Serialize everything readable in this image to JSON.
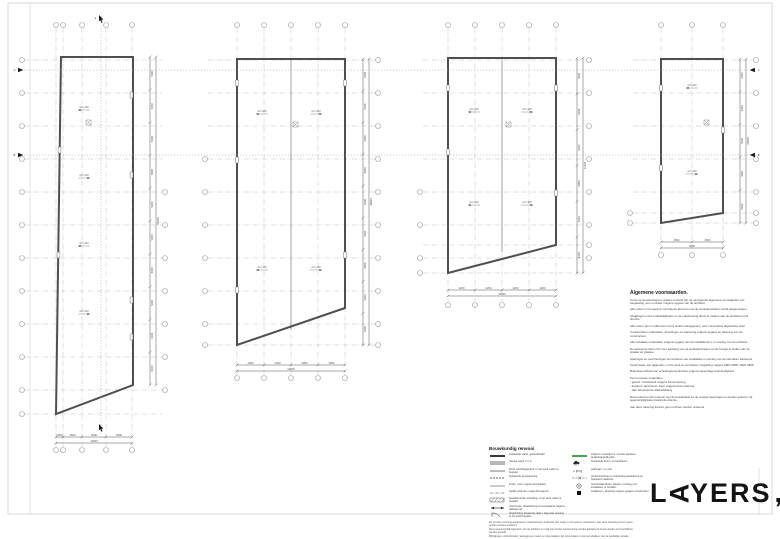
{
  "colors": {
    "grid": "#b9b9b9",
    "wall": "#4f4f4f",
    "dim": "#555555",
    "bubble": "#9a9a9a",
    "section": "#1c1c1c",
    "green": "#2e9e44",
    "frame": "#d9d9d9"
  },
  "logo": {
    "pre": "L",
    "rotated_letter": "A",
    "post": "YERS",
    "comma": ","
  },
  "legend": {
    "title": "Bouwkundig renvooi",
    "left_items": [
      {
        "sym": "line-thick",
        "label": "bestaande wand, gehandhaafd"
      },
      {
        "sym": "line-double",
        "label": "nieuwe wand / n.t.b."
      },
      {
        "sym": "line-double-thin",
        "label": "lichte scheidingswand, in het werk nader te bepalen"
      },
      {
        "sym": "line-dashed",
        "label": "bestaande gevelopening"
      },
      {
        "sym": "line-thin",
        "label": "kozijn, merk volgens kozijnstaat"
      },
      {
        "sym": "line-dashdot",
        "label": "hartlijn stramien / eigendomsgrens"
      },
      {
        "sym": "rect-hatch",
        "label": "brandwerende scheiding, in het werk nader te bepalen"
      },
      {
        "sym": "arrow",
        "label": "vluchtroute, draairichting en loopafstand volgens plattegrond"
      },
      {
        "sym": "arc",
        "label": "draairichting draaiende delen, dagmaat opening in het werk bepalen"
      }
    ],
    "right_items": [
      {
        "sym": "line-green",
        "label": "erfgrens / kavelgrens, nieuwe aanplant landschappelijk plan"
      },
      {
        "sym": "tree",
        "label": "bestaande boom, te handhaven"
      },
      {
        "sym": "text-peil",
        "label": "peilmaat t.o.v. peil"
      },
      {
        "sym": "line-x",
        "label": "terreininrichting en verharding aansluitend op bestaand maaiveld"
      },
      {
        "sym": "circle-dot",
        "label": "hemelwaterafvoer, plaats in overleg met installateur te bepalen"
      },
      {
        "sym": "square",
        "label": "staalkolom, afmeting volgens opgave constructeur"
      }
    ],
    "peil_text": "+ P=0",
    "footnote_lines": [
      "De op deze tekening aangegeven maatvoering is indicatief; alle maten in het werk te controleren. Aan deze tekening kunnen geen rechten worden ontleend.",
      "Deze tekening blijft eigendom van de architect en mag niet zonder toestemming worden gekopieerd of aan derden ter beschikking worden gesteld.",
      "Wijzigingen voorbehouden; aangegeven maten en oppervlakten zijn circa-maten en kunnen afwijken van de werkelijke situatie."
    ]
  },
  "conditions": {
    "title": "Algemene voorwaarden.",
    "lines": [
      "Tenzij op de tekening(en) anders vermeld zijn de navolgende algemene voorwaarden van toepassing, een en ander volgens opgave van de architect.",
      "",
      "Alle maten in het werk te controleren alvorens met de werkzaamheden wordt aangevangen.",
      "",
      "Afwijkingen en/of onduidelijkheden in de maatvoering direct te melden aan de architect en/of directie.",
      "",
      "Alle maten zijn in millimeters tenzij anders aangegeven, peil = bovenkant afgewerkte vloer.",
      "",
      "Constructieve onderdelen, afmetingen en wapening volgens opgave en tekening van de constructeur.",
      "",
      "Alle installatie-onderdelen volgens opgave van de installateur(s), in overleg met de architect.",
      "",
      "De aannemer dient zich voor aanvang van de werkzaamheden op de hoogte te stellen van de situatie ter plaatse.",
      "",
      "Sparingen en voorzieningen ten behoeve van installaties in overleg met de betrokken adviseurs.",
      "",
      "Kozijnmaten zijn dagmaten, in het werk te controleren; beglazing volgens NEN 2608 / NEN 3569.",
      "",
      "Brandwerendheid van scheidingsconstructies volgens rapportage brandveiligheid.",
      "",
      "Toe te passen materialen:",
      "-  gevels: metselwerk volgens bemonstering",
      "-  kozijnen: aluminium, kleur volgens bemonstering",
      "-  dak: bitumineuze dakbedekking",
      "",
      "Deze tekening dient samen met de bestektekst en de overige tekeningen te worden gelezen; bij tegenstrijdigheden beslist de directie.",
      "",
      "Aan deze tekening kunnen geen rechten worden ontleend."
    ]
  },
  "plans": [
    {
      "bottom_dims": [
        "1000",
        "3600",
        "3600",
        "3600"
      ],
      "bottom_total": "11800",
      "right_dims": [
        "5400",
        "5200",
        "5200",
        "6000",
        "5200",
        "5200",
        "6000",
        "5200",
        "5200",
        "5400"
      ],
      "right_total": "54000",
      "interior_label": "af 1:100"
    },
    {
      "bottom_dims": [
        "4450",
        "4450",
        "3950",
        "3950"
      ],
      "bottom_total": "16800",
      "right_dims": [
        "5400",
        "5200",
        "5200",
        "6000",
        "5200",
        "5200",
        "6000",
        "5200",
        "5400"
      ],
      "right_total": "48800",
      "interior_label": "af 1:100"
    },
    {
      "bottom_dims": [
        "4200",
        "4200",
        "4200",
        "4200"
      ],
      "bottom_total": "16800",
      "right_dims": [
        "5400",
        "5200",
        "5200",
        "6000",
        "5200",
        "4300"
      ],
      "right_total": "31300",
      "interior_label": "af 1:100"
    },
    {
      "bottom_dims": [
        "4500",
        "4500"
      ],
      "bottom_total": "9000",
      "right_dims": [
        "5400",
        "5300",
        "5200",
        "4300",
        "5400"
      ],
      "right_total": "25600",
      "interior_label": "af 1:100"
    }
  ],
  "section_markers": {
    "vertical_letter": "a",
    "horizontal_top_letter": "A",
    "horizontal_bottom_letter": "B"
  }
}
